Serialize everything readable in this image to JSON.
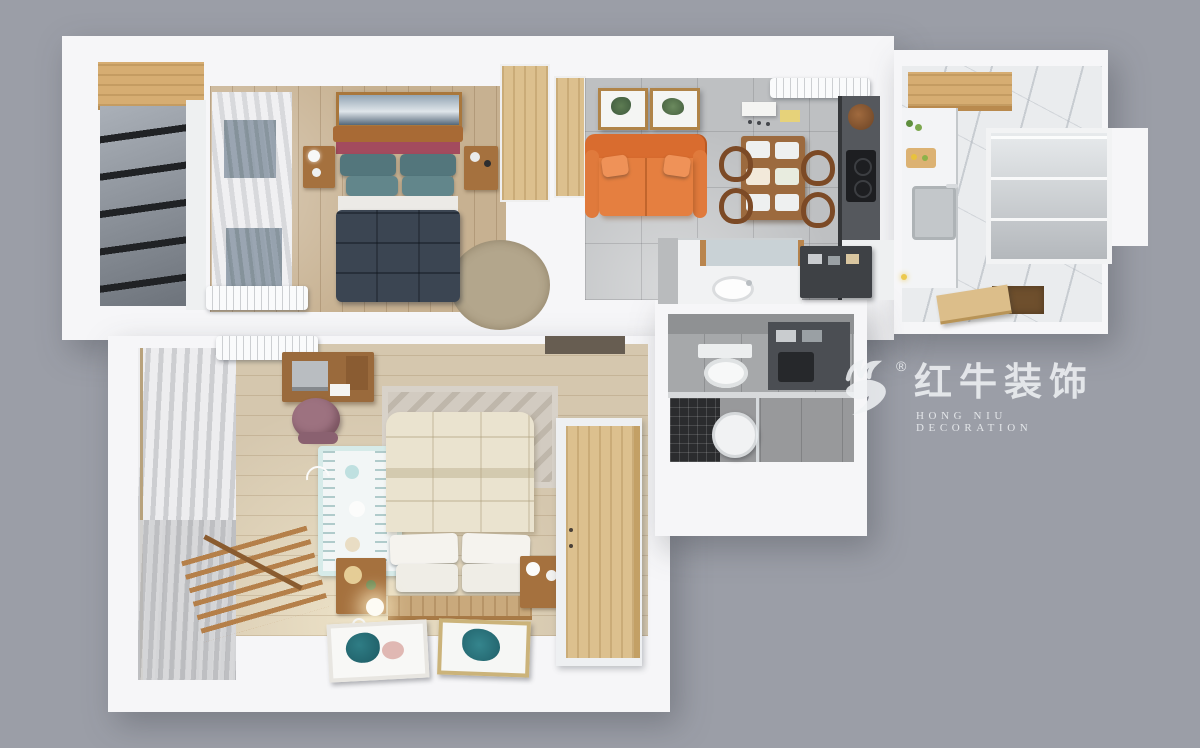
{
  "watermark": {
    "logo_icon": "bull-logo-icon",
    "registered_symbol": "®",
    "brand_name_cn": "红牛装饰",
    "brand_name_en": "HONG NIU DECORATION",
    "text_color": "#eef0f4"
  },
  "palette": {
    "background": "#9b9ea7",
    "wall_white": "#f6f6f8",
    "wood_floor": "#c7b191",
    "light_wood_cabinet": "#dcc08e",
    "living_tile_gray": "#bec0c2",
    "sofa_orange": "#e2793c",
    "master_bed_navy": "#3b4552",
    "pillow_teal": "#5d8186",
    "headboard_maroon": "#a34b5e",
    "bathroom_tile": "#a6a8aa",
    "shower_mosaic_black": "#2b2c2e",
    "kids_bedding_cream": "#eae3cf",
    "kitchen_marble": "#eaecee",
    "entry_light_dot": "#ecc94f"
  }
}
